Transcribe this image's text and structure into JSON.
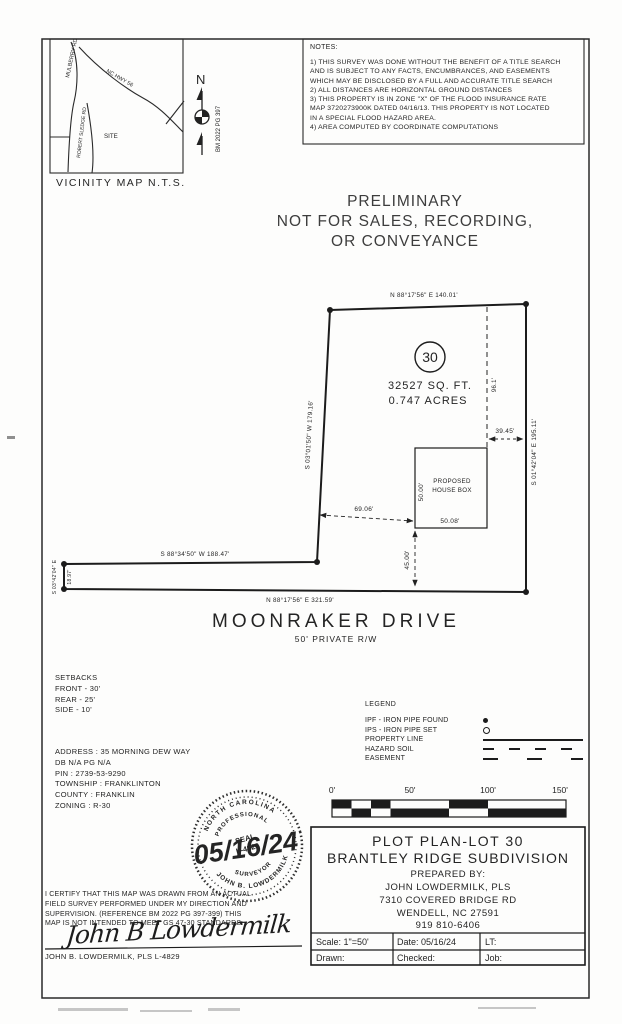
{
  "document": {
    "vicinity": {
      "title": "VICINITY MAP N.T.S.",
      "road_mulberry": "MULBERRY RD",
      "road_hwy": "NC HWY 56",
      "road_sledge": "ROBERT SLEDGE RD",
      "site": "SITE",
      "north_label": "N",
      "bm_ref": "BM 2022 PG 397"
    },
    "notes": {
      "title": "NOTES:",
      "body": "1) THIS SURVEY WAS DONE WITHOUT THE BENEFIT OF A TITLE SEARCH\nAND IS SUBJECT TO ANY FACTS, ENCUMBRANCES, AND EASEMENTS\nWHICH MAY BE DISCLOSED BY A FULL AND ACCURATE TITLE SEARCH\n2) ALL DISTANCES ARE HORIZONTAL GROUND DISTANCES\n3) THIS PROPERTY IS IN ZONE \"X\" OF THE FLOOD INSURANCE RATE\nMAP 3720273900K DATED 04/16/13. THIS PROPERTY IS NOT LOCATED\nIN A SPECIAL FLOOD HAZARD AREA.\n4) AREA COMPUTED BY COORDINATE COMPUTATIONS"
    },
    "preliminary": "PRELIMINARY\nNOT FOR SALES, RECORDING,\nOR CONVEYANCE",
    "plot": {
      "lot_number": "30",
      "area_sqft": "32527 SQ. FT.",
      "area_acres": "0.747 ACRES",
      "bearing_top": "N 88°17'56\" E   140.01'",
      "bearing_right": "S 01°42'04\" E   195.11'",
      "bearing_left": "S 03°01'50\" W   179.16'",
      "bearing_mid": "S 88°34'50\" W   188.47'",
      "bearing_west": "S 03°42'04\" E",
      "dist_west": "18.97'",
      "bearing_bottom": "N 88°17'56\" E   321.59'",
      "dim_house_to_top": "96.1'",
      "dim_house_to_east": "39.45'",
      "dim_house_to_west": "69.06'",
      "dim_house_to_road": "45.00'",
      "house_line1": "PROPOSED",
      "house_line2": "HOUSE BOX",
      "house_width": "50.00'",
      "house_length": "50.08'",
      "street": "MOONRAKER DRIVE",
      "street_sub": "50' PRIVATE R/W"
    },
    "setbacks": "SETBACKS\nFRONT - 30'\nREAR - 25'\nSIDE - 10'",
    "address": "ADDRESS : 35 MORNING DEW WAY\nDB N/A PG N/A\nPIN : 2739-53-9290\nTOWNSHIP : FRANKLINTON\nCOUNTY : FRANKLIN\nZONING : R-30",
    "legend": {
      "title": "LEGEND",
      "ipf": "IPF - IRON PIPE FOUND",
      "ips": "IPS - IRON PIPE SET",
      "property": "PROPERTY LINE",
      "hazard": "HAZARD SOIL",
      "easement": "EASEMENT"
    },
    "scalebar": {
      "t0": "0'",
      "t50": "50'",
      "t100": "100'",
      "t150": "150'"
    },
    "seal": {
      "arc_top": "NORTH CAROLINA",
      "arc_top_inner": "PROFESSIONAL",
      "center_line1": "SEAL",
      "center_line2": "L-4829",
      "arc_bottom_inner": "SURVEYOR",
      "arc_bottom": "JOHN B. LOWDERMILK",
      "date": "05/16/24"
    },
    "certification": {
      "body": "I CERTIFY THAT THIS MAP WAS DRAWN FROM AN ACTUAL\nFIELD SURVEY PERFORMED UNDER MY DIRECTION AND\nSUPERVISION. (REFERENCE BM 2022 PG 397-399) THIS\nMAP IS NOT INTENDED TO MEET GS 47-30 STANDARDS.",
      "signature": "John B Lowdermilk",
      "printed": "JOHN B. LOWDERMILK, PLS L-4829"
    },
    "titleblock": {
      "title_line1": "PLOT PLAN-LOT 30",
      "title_line2": "BRANTLEY RIDGE SUBDIVISION",
      "prepared_by": "PREPARED BY:",
      "preparer": "JOHN LOWDERMILK, PLS",
      "street": "7310 COVERED BRIDGE RD",
      "city": "WENDELL, NC 27591",
      "phone": "919 810-6406",
      "scale": "Scale:  1\"=50'",
      "date": "Date: 05/16/24",
      "lt": "LT:",
      "drawn": "Drawn:",
      "checked": "Checked:",
      "job": "Job:"
    }
  }
}
